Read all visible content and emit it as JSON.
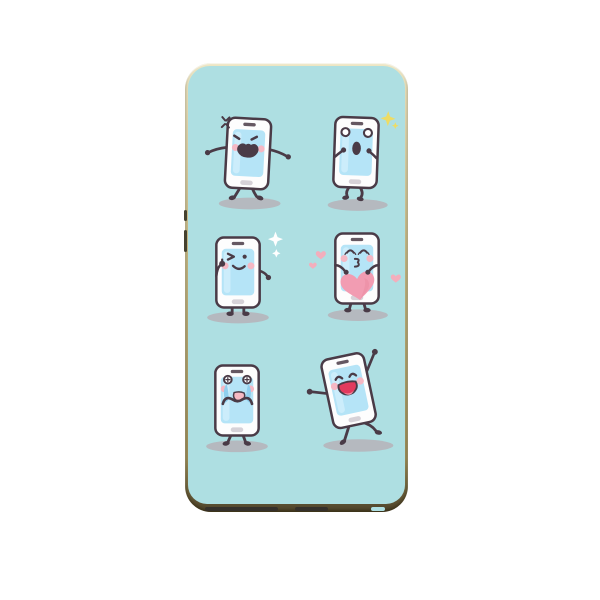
{
  "window": {
    "type": "product-photo",
    "description": "Phone case with cartoon smartphone emoji characters print"
  },
  "case": {
    "name": "phone-case",
    "frame_style": "gold metallic bezel",
    "print_background": "light teal",
    "side_buttons": 2,
    "bottom_ports": 2
  },
  "characters": [
    {
      "name": "angry-phone",
      "expression": "angry, arms out, stomping",
      "extras": "anger-mark-icon",
      "row": 1,
      "col": 1
    },
    {
      "name": "shocked-phone",
      "expression": "surprised, hands to face",
      "extras": "yellow-sparkle-icon",
      "row": 1,
      "col": 2
    },
    {
      "name": "winking-phone",
      "expression": "winking with thumbs-up",
      "extras": "white-sparkle-icons",
      "row": 2,
      "col": 1
    },
    {
      "name": "kissing-phone",
      "expression": "blowing kiss, holding heart",
      "extras": "pink-heart-icons",
      "row": 2,
      "col": 2
    },
    {
      "name": "crying-phone",
      "expression": "crying, fists at mouth",
      "extras": "tear-streams",
      "row": 3,
      "col": 1
    },
    {
      "name": "dancing-phone",
      "expression": "laughing, dancing, arm raised",
      "extras": "tilted-pose",
      "row": 3,
      "col": 2
    }
  ],
  "colors": {
    "page_bg": "#ffffff",
    "case_teal": "#aedfe2",
    "gold_hi": "#efe7c4",
    "gold_mid": "#c4b784",
    "gold_low": "#9b8c58",
    "gold_dark": "#4e432a",
    "btn_dark": "#45412f",
    "port_dark": "#35302a",
    "outline": "#4a3b47",
    "body_white": "#fdfdfd",
    "screen_blue": "#b5e4f7",
    "screen_hi": "#ccedfb",
    "home_gray": "#d6d2d8",
    "shadow_gray": "#b5b9bf",
    "cheek_pink": "#f5b8c4",
    "heart_pink": "#f29cb2",
    "heart_light": "#f3aebc",
    "heart_shade": "#e9899f",
    "tear_blue": "#90cfee",
    "sparkle_yellow": "#eedc64",
    "sparkle_white": "#ffffff",
    "mouth_red": "#e23a5e",
    "tongue_pink": "#fa8fa4",
    "mouth_pink": "#f6b9c3"
  }
}
